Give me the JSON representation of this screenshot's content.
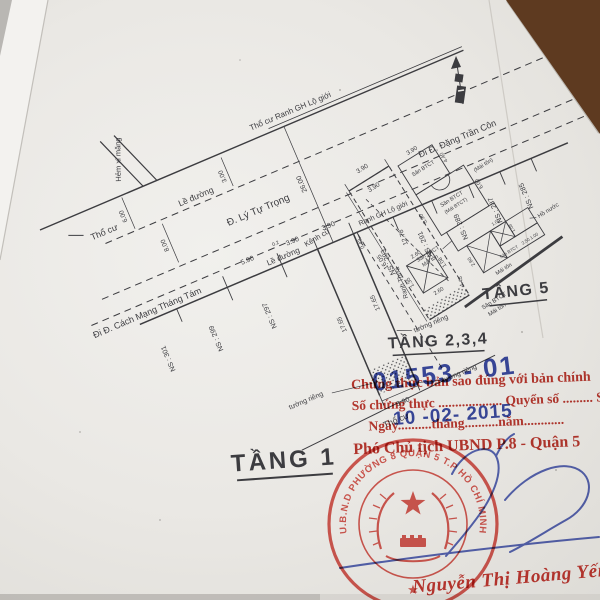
{
  "site_plan": {
    "title": "TẦNG 1",
    "labels": {
      "boundary_top": "Thổ cư Ranh GH Lộ giới",
      "alley": "Hẻm xi măng",
      "residential_left": "Thổ cư",
      "sidewalk_top": "Lề đường",
      "road": "Đ. Lý Tự Trọng",
      "to_street_right": "Đi Đ. Đặng Trần Côn",
      "to_street_left": "Đi Đ. Cách Mạng Tháng Tám",
      "sidewalk_bottom": "Lề đường",
      "boundary_frontage": "Ranh GH Lộ giới",
      "old_canal": "Kênh cũ",
      "party_wall_1": "tường riêng",
      "party_wall_2": "tường riêng",
      "party_wall_3": "tường riêng",
      "parcel_boundary": "Ranh Thửa",
      "residential_bottom": "Thổ cư"
    },
    "dimensions": {
      "left_offset": "6.00",
      "road_width_left": "8.00",
      "sidewalk_top": "3.00",
      "cross": "26.00",
      "frontage": [
        "5.90",
        "3.90",
        "3.90",
        "0.43"
      ],
      "jog": "0.2",
      "side_left": "17.65",
      "side_right": "17.65",
      "rear": "3.90"
    },
    "house_numbers": [
      "NS : 301",
      "NS : 299",
      "NS : 297",
      "NS : 293",
      "NS : 291",
      "NS : 289",
      "NS : 287",
      "NS : 285"
    ]
  },
  "plan_234": {
    "title": "TẦNG 2,3,4",
    "dimensions": {
      "front": "3.90",
      "front_inner": "3.90",
      "length_inner": "12.78",
      "length": "16.05",
      "void_top": "2.60",
      "void_left": "1.35",
      "void_right": "1.08",
      "void_bottom": "2.60",
      "rear_diag": "4.45"
    }
  },
  "plan_5": {
    "title": "TẦNG 5",
    "labels": {
      "terrace_top": "Sân BTCT",
      "terrace_mid": "Sân BTCT",
      "roof_concrete": "(Mái BTCT)",
      "roof_metal_right": "(Mái tôn)",
      "terrace_left_1": "Sân BTCT",
      "terrace_left_2": "Mái tôn",
      "water_tank": "Hồ nước",
      "terrace_small": "Sân BTCT",
      "terrace_small_dims": "2.50 1.00",
      "roof_small": "Mái tôn",
      "terrace_bottom_1": "Sân BTCT",
      "terrace_bottom_2": "Mái tôn"
    },
    "dimensions": {
      "top": "3.90",
      "right_1": "4.40",
      "right_2": "6.00",
      "left": "5.90",
      "c1": "2.60",
      "c2": "1.00",
      "c3": "1.08"
    }
  },
  "certification": {
    "line1": "Chứng thực bản sao đúng với bản chính",
    "line2": "Số chứng thực ................... Quyển số ......... SCT/BS",
    "line3": "Ngày..........tháng..........năm............",
    "line4": "Phó Chủ tịch UBND P.8 - Quận 5",
    "number_stamp": "01553 - 01",
    "date_stamp": "10 -02- 2015",
    "signer": "Nguyễn Thị Hoàng Yến"
  },
  "seal": {
    "ring_text": "U.B.N.D PHƯỜNG 8 QUẬN 5 T.P HỒ CHÍ MINH",
    "star": "★"
  },
  "colors": {
    "stamp_red": "#c03a31",
    "stamp_blue": "#2c3da0",
    "seal_red": "#d5453d",
    "ink": "#3c3c40",
    "paper": "#ecebe7",
    "background_teal": "#497380",
    "background_wood": "#7c4a28"
  }
}
